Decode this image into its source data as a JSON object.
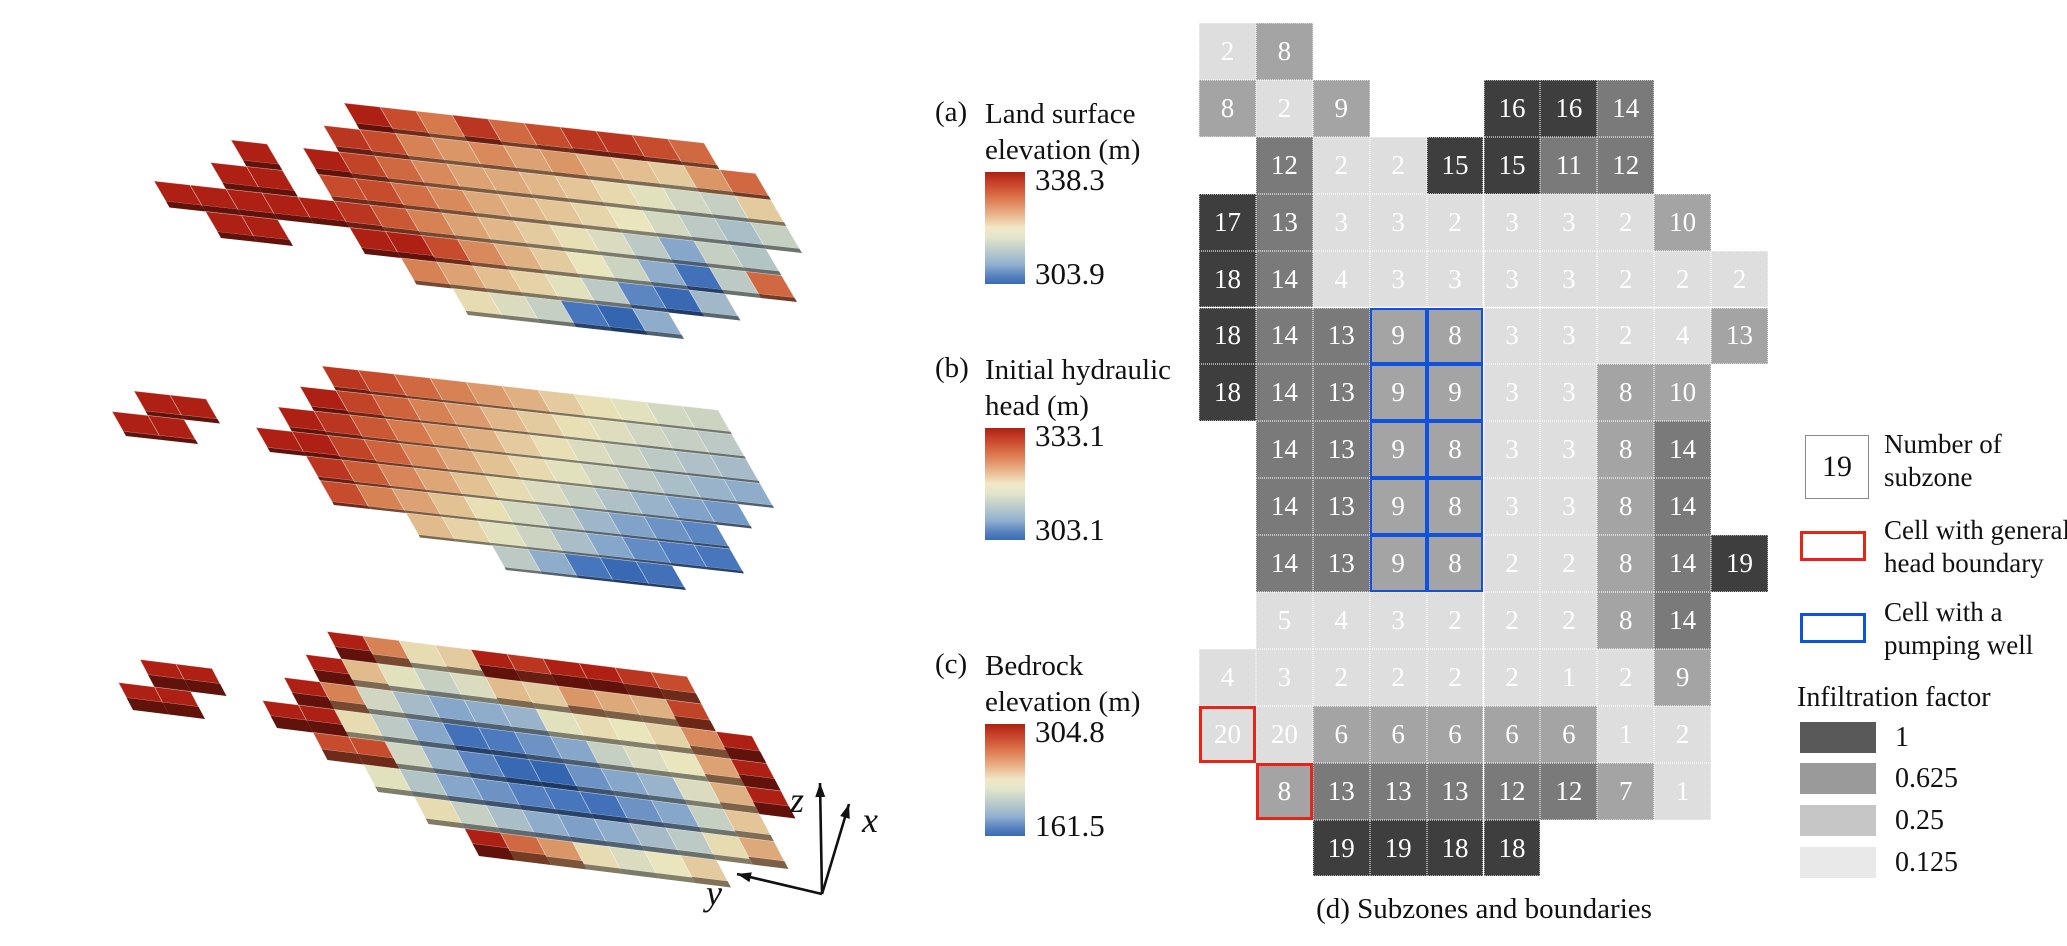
{
  "panels": {
    "a": {
      "tag": "(a)",
      "title1": "Land surface",
      "title2": "elevation (m)",
      "max": "338.3",
      "min": "303.9"
    },
    "b": {
      "tag": "(b)",
      "title1": "Initial hydraulic",
      "title2": "head (m)",
      "max": "333.1",
      "min": "303.1"
    },
    "c": {
      "tag": "(c)",
      "title1": "Bedrock",
      "title2": "elevation (m)",
      "max": "304.8",
      "min": "161.5"
    },
    "d_caption": "(d) Subzones and boundaries"
  },
  "axes": {
    "x": "x",
    "y": "y",
    "z": "z"
  },
  "legend": {
    "subzone_value": "19",
    "subzone_line1": "Number of",
    "subzone_line2": "subzone",
    "ghb_line1": "Cell with general",
    "ghb_line2": "head boundary",
    "well_line1": "Cell with a",
    "well_line2": "pumping well",
    "infiltration_title": "Infiltration factor",
    "classes": [
      {
        "label": "1",
        "color": "#595959"
      },
      {
        "label": "0.625",
        "color": "#9a9a9a"
      },
      {
        "label": "0.25",
        "color": "#c6c6c6"
      },
      {
        "label": "0.125",
        "color": "#e9e9e9"
      }
    ]
  },
  "colors": {
    "boundary_red": "#e8231a",
    "well_blue": "#0f52e0",
    "cell_text": "#ffffff",
    "factor_fill": {
      "1": "#3e3e3e",
      "0.625": "#7a7a7a",
      "0.25": "#a4a4a4",
      "0.125": "#dedede"
    }
  },
  "chart_data": [
    {
      "type": "heatmap",
      "id": "d",
      "title": "Subzones and boundaries",
      "rows": 15,
      "cols": 10,
      "subzone": [
        [
          2,
          8,
          null,
          null,
          null,
          null,
          null,
          null,
          null,
          null
        ],
        [
          8,
          2,
          9,
          null,
          null,
          16,
          16,
          14,
          null,
          null
        ],
        [
          null,
          12,
          2,
          2,
          15,
          15,
          11,
          12,
          null,
          null
        ],
        [
          17,
          13,
          3,
          3,
          2,
          3,
          3,
          2,
          10,
          null
        ],
        [
          18,
          14,
          4,
          3,
          3,
          3,
          3,
          2,
          2,
          2
        ],
        [
          18,
          14,
          13,
          9,
          8,
          3,
          3,
          2,
          4,
          13
        ],
        [
          18,
          14,
          13,
          9,
          9,
          3,
          3,
          8,
          10,
          null
        ],
        [
          null,
          14,
          13,
          9,
          8,
          3,
          3,
          8,
          14,
          null
        ],
        [
          null,
          14,
          13,
          9,
          8,
          3,
          3,
          8,
          14,
          null
        ],
        [
          null,
          14,
          13,
          9,
          8,
          2,
          2,
          8,
          14,
          19
        ],
        [
          null,
          5,
          4,
          3,
          2,
          2,
          2,
          8,
          14,
          null
        ],
        [
          4,
          3,
          2,
          2,
          2,
          2,
          1,
          2,
          9,
          null
        ],
        [
          20,
          20,
          6,
          6,
          6,
          6,
          6,
          1,
          2,
          null
        ],
        [
          null,
          8,
          13,
          13,
          13,
          12,
          12,
          7,
          1,
          null
        ],
        [
          null,
          null,
          19,
          19,
          18,
          18,
          null,
          null,
          null,
          null
        ]
      ],
      "infiltration_factor": [
        [
          0.125,
          0.25,
          null,
          null,
          null,
          null,
          null,
          null,
          null,
          null
        ],
        [
          0.25,
          0.125,
          0.25,
          null,
          null,
          1,
          1,
          0.625,
          null,
          null
        ],
        [
          null,
          0.625,
          0.125,
          0.125,
          1,
          1,
          0.625,
          0.625,
          null,
          null
        ],
        [
          1,
          0.625,
          0.125,
          0.125,
          0.125,
          0.125,
          0.125,
          0.125,
          0.25,
          null
        ],
        [
          1,
          0.625,
          0.125,
          0.125,
          0.125,
          0.125,
          0.125,
          0.125,
          0.125,
          0.125
        ],
        [
          1,
          0.625,
          0.625,
          0.25,
          0.25,
          0.125,
          0.125,
          0.125,
          0.125,
          0.25
        ],
        [
          1,
          0.625,
          0.625,
          0.25,
          0.25,
          0.125,
          0.125,
          0.25,
          0.25,
          null
        ],
        [
          null,
          0.625,
          0.625,
          0.25,
          0.25,
          0.125,
          0.125,
          0.25,
          0.625,
          null
        ],
        [
          null,
          0.625,
          0.625,
          0.25,
          0.25,
          0.125,
          0.125,
          0.25,
          0.625,
          null
        ],
        [
          null,
          0.625,
          0.625,
          0.25,
          0.25,
          0.125,
          0.125,
          0.25,
          0.625,
          1
        ],
        [
          null,
          0.125,
          0.125,
          0.125,
          0.125,
          0.125,
          0.125,
          0.25,
          0.625,
          null
        ],
        [
          0.125,
          0.125,
          0.125,
          0.125,
          0.125,
          0.125,
          0.125,
          0.125,
          0.25,
          null
        ],
        [
          0.125,
          0.125,
          0.25,
          0.25,
          0.25,
          0.25,
          0.25,
          0.125,
          0.125,
          null
        ],
        [
          null,
          0.25,
          0.625,
          0.625,
          0.625,
          0.625,
          0.625,
          0.25,
          0.125,
          null
        ],
        [
          null,
          null,
          1,
          1,
          1,
          1,
          null,
          null,
          null,
          null
        ]
      ],
      "pumping_well_cells": [
        [
          6,
          4
        ],
        [
          6,
          5
        ],
        [
          7,
          4
        ],
        [
          7,
          5
        ],
        [
          8,
          4
        ],
        [
          8,
          5
        ],
        [
          9,
          4
        ],
        [
          9,
          5
        ],
        [
          10,
          4
        ],
        [
          10,
          5
        ]
      ],
      "general_head_boundary_cells": [
        [
          13,
          1
        ],
        [
          14,
          2
        ]
      ],
      "legend_factors": [
        1,
        0.625,
        0.25,
        0.125
      ]
    },
    {
      "type": "3d-surface",
      "id": "a",
      "title": "Land surface elevation (m)",
      "colorbar_max": 338.3,
      "colorbar_min": 303.9,
      "colormap": "red-yellow-blue",
      "relief": [
        [
          null,
          null,
          null,
          null,
          null,
          null,
          null,
          1,
          0.9,
          0.82,
          0.95,
          0.85,
          0.9,
          0.95,
          0.95,
          0.9,
          0.85,
          null
        ],
        [
          null,
          null,
          null,
          null,
          null,
          null,
          0.95,
          0.9,
          0.8,
          0.75,
          0.78,
          0.72,
          0.75,
          0.68,
          0.64,
          0.6,
          0.75,
          0.85
        ],
        [
          null,
          null,
          null,
          1,
          null,
          1,
          0.92,
          0.85,
          0.78,
          0.72,
          0.7,
          0.66,
          0.62,
          0.56,
          0.5,
          0.45,
          0.42,
          0.6
        ],
        [
          null,
          null,
          1,
          1,
          null,
          0.9,
          0.9,
          0.84,
          0.78,
          0.7,
          0.66,
          0.62,
          0.57,
          0.52,
          0.46,
          0.4,
          0.36,
          0.42
        ],
        [
          1,
          1,
          1,
          1,
          1,
          0.95,
          0.88,
          0.8,
          0.72,
          0.66,
          0.6,
          0.54,
          0.48,
          0.4,
          0.28,
          0.42,
          0.38,
          null
        ],
        [
          null,
          1,
          1,
          null,
          null,
          1,
          1,
          0.9,
          0.78,
          0.68,
          0.6,
          0.52,
          0.44,
          0.3,
          0.1,
          0.4,
          0.85,
          null
        ],
        [
          null,
          null,
          null,
          null,
          null,
          null,
          0.8,
          0.72,
          0.64,
          0.58,
          0.5,
          0.4,
          0.18,
          0.06,
          0.34,
          null,
          null,
          null
        ],
        [
          null,
          null,
          null,
          null,
          null,
          null,
          null,
          0.55,
          0.48,
          0.42,
          0.12,
          0.04,
          0.3,
          null,
          null,
          null,
          null,
          null
        ]
      ]
    },
    {
      "type": "3d-surface",
      "id": "b",
      "title": "Initial hydraulic head (m)",
      "colorbar_max": 333.1,
      "colorbar_min": 303.1,
      "colormap": "red-yellow-blue",
      "relief": [
        [
          null,
          null,
          null,
          null,
          null,
          null,
          null,
          0.95,
          0.9,
          0.85,
          0.8,
          0.74,
          0.68,
          0.6,
          0.54,
          0.5,
          0.46,
          0.44
        ],
        [
          null,
          null,
          null,
          null,
          null,
          null,
          1,
          0.92,
          0.86,
          0.8,
          0.74,
          0.66,
          0.6,
          0.54,
          0.49,
          0.45,
          0.42,
          0.4
        ],
        [
          null,
          1,
          1,
          null,
          null,
          1,
          0.95,
          0.88,
          0.82,
          0.75,
          0.68,
          0.6,
          0.54,
          0.48,
          0.44,
          0.4,
          0.37,
          0.35
        ],
        [
          1,
          1,
          null,
          null,
          1,
          1,
          0.92,
          0.86,
          0.78,
          0.7,
          0.63,
          0.56,
          0.5,
          0.45,
          0.4,
          0.36,
          0.32,
          0.3
        ],
        [
          null,
          null,
          null,
          null,
          null,
          0.95,
          0.87,
          0.79,
          0.71,
          0.63,
          0.55,
          0.48,
          0.42,
          0.37,
          0.32,
          0.27,
          0.24,
          null
        ],
        [
          null,
          null,
          null,
          null,
          null,
          0.9,
          0.8,
          0.72,
          0.63,
          0.54,
          0.46,
          0.4,
          0.33,
          0.27,
          0.22,
          0.18,
          null,
          null
        ],
        [
          null,
          null,
          null,
          null,
          null,
          null,
          null,
          0.65,
          0.58,
          0.5,
          0.44,
          0.36,
          0.28,
          0.2,
          0.15,
          0.12,
          null,
          null
        ],
        [
          null,
          null,
          null,
          null,
          null,
          null,
          null,
          null,
          null,
          0.4,
          0.3,
          0.12,
          0.06,
          0.1,
          null,
          null,
          null,
          null
        ]
      ]
    },
    {
      "type": "3d-surface",
      "id": "c",
      "title": "Bedrock elevation (m)",
      "colorbar_max": 304.8,
      "colorbar_min": 161.5,
      "colormap": "red-yellow-blue",
      "relief": [
        [
          null,
          null,
          null,
          null,
          null,
          null,
          null,
          1,
          0.8,
          0.55,
          0.6,
          1,
          0.95,
          1,
          1,
          0.95,
          0.9,
          null
        ],
        [
          null,
          null,
          null,
          null,
          null,
          null,
          1,
          0.65,
          0.5,
          0.42,
          0.48,
          0.65,
          0.6,
          0.75,
          0.7,
          0.68,
          0.92,
          null
        ],
        [
          null,
          1,
          1,
          null,
          null,
          1,
          0.8,
          0.45,
          0.35,
          0.28,
          0.3,
          0.32,
          0.5,
          0.55,
          0.52,
          0.58,
          0.78,
          1
        ],
        [
          1,
          1,
          null,
          null,
          1,
          1,
          0.55,
          0.4,
          0.28,
          0.1,
          0.14,
          0.22,
          0.28,
          0.42,
          0.48,
          0.52,
          0.72,
          1
        ],
        [
          null,
          null,
          null,
          null,
          null,
          0.9,
          0.9,
          0.45,
          0.32,
          0.18,
          0.06,
          0.04,
          0.22,
          0.28,
          0.32,
          0.48,
          0.68,
          1
        ],
        [
          null,
          null,
          null,
          null,
          null,
          null,
          0.5,
          0.38,
          0.28,
          0.22,
          0.16,
          0.12,
          0.1,
          0.22,
          0.28,
          0.42,
          0.62,
          null
        ],
        [
          null,
          null,
          null,
          null,
          null,
          null,
          null,
          0.55,
          0.42,
          0.36,
          0.3,
          0.26,
          0.3,
          0.35,
          0.4,
          0.55,
          0.7,
          null
        ],
        [
          null,
          null,
          null,
          null,
          null,
          null,
          null,
          null,
          1,
          0.85,
          0.75,
          0.55,
          0.48,
          0.52,
          0.6,
          null,
          null,
          null
        ]
      ]
    }
  ]
}
